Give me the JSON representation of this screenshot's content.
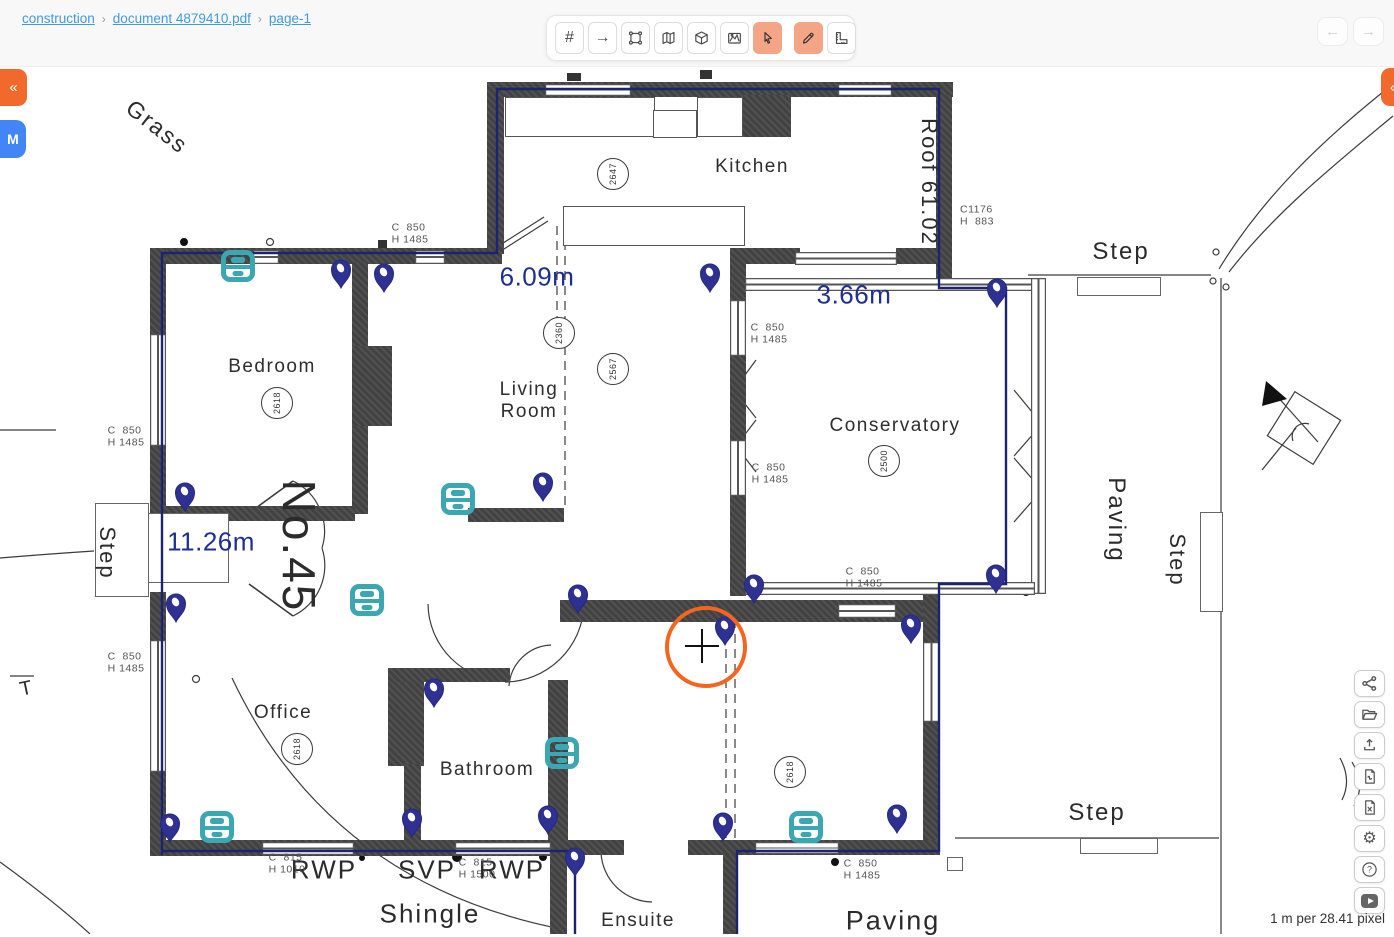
{
  "breadcrumb": {
    "separator": "›",
    "items": [
      {
        "label": "construction"
      },
      {
        "label": "document 4879410.pdf"
      },
      {
        "label": "page-1"
      }
    ]
  },
  "top_toolbar": {
    "tools": [
      {
        "name": "grid-tool",
        "glyph": "#",
        "active": false
      },
      {
        "name": "arrow-tool",
        "glyph": "→",
        "active": false
      },
      {
        "name": "polygon-select-tool",
        "active": false
      },
      {
        "name": "map-tool",
        "active": false
      },
      {
        "name": "cube-tool",
        "active": false
      },
      {
        "name": "area-chart-tool",
        "active": false
      },
      {
        "name": "pointer-tool",
        "active": true
      },
      {
        "name": "pencil-tool",
        "active": true
      },
      {
        "name": "ruler-tool",
        "active": false
      }
    ]
  },
  "nav_arrows": {
    "back": "←",
    "forward": "→"
  },
  "edge_buttons": {
    "left_collapse": "«",
    "left_m": "M",
    "right_collapse": "«"
  },
  "right_toolbar": {
    "buttons": [
      {
        "name": "share"
      },
      {
        "name": "open-folder"
      },
      {
        "name": "upload"
      },
      {
        "name": "export-pdf"
      },
      {
        "name": "export-excel"
      },
      {
        "name": "settings"
      },
      {
        "name": "help"
      },
      {
        "name": "youtube"
      }
    ]
  },
  "status": {
    "scale_label": "1 m per 28.41 pixel"
  },
  "colors": {
    "accent_orange": "#f2692c",
    "active_tool": "#f3a585",
    "link_blue": "#3f9ae3",
    "pin_navy": "#2e3192",
    "marker_teal": "#3ba7b3",
    "measure_navy": "#1e2f92",
    "m_button_blue": "#4285f4",
    "cursor_orange": "#f4661f"
  },
  "plan": {
    "rooms": [
      {
        "name": "Kitchen",
        "x": 752,
        "y": 167
      },
      {
        "name": "Bedroom",
        "x": 272,
        "y": 367
      },
      {
        "name": "Living\nRoom",
        "x": 529,
        "y": 401
      },
      {
        "name": "Conservatory",
        "x": 895,
        "y": 426
      },
      {
        "name": "Office",
        "x": 283,
        "y": 713
      },
      {
        "name": "Bathroom",
        "x": 487,
        "y": 770
      },
      {
        "name": "Ensuite",
        "x": 638,
        "y": 921
      }
    ],
    "area_labels": [
      {
        "text": "Grass",
        "x": 157,
        "y": 127,
        "rot": 38,
        "size": 23
      },
      {
        "text": "Step",
        "x": 1121,
        "y": 252,
        "rot": 0,
        "size": 24
      },
      {
        "text": "Step",
        "x": 107,
        "y": 553,
        "rot": 90,
        "size": 22
      },
      {
        "text": "Paving",
        "x": 1116,
        "y": 520,
        "rot": 90,
        "size": 24
      },
      {
        "text": "Step",
        "x": 1177,
        "y": 560,
        "rot": 90,
        "size": 22
      },
      {
        "text": "Step",
        "x": 1097,
        "y": 813,
        "rot": 0,
        "size": 24
      },
      {
        "text": "Paving",
        "x": 893,
        "y": 921,
        "rot": 0,
        "size": 27
      },
      {
        "text": "Shingle",
        "x": 430,
        "y": 914,
        "rot": 0,
        "size": 26
      },
      {
        "text": "RWP",
        "x": 324,
        "y": 870,
        "rot": 0,
        "size": 26
      },
      {
        "text": "SVP",
        "x": 427,
        "y": 870,
        "rot": 0,
        "size": 26
      },
      {
        "text": "RWP",
        "x": 512,
        "y": 870,
        "rot": 0,
        "size": 26
      },
      {
        "text": "No.45",
        "x": 299,
        "y": 546,
        "rot": 90,
        "size": 46,
        "weight": 500
      },
      {
        "text": "Roof 61.02",
        "x": 929,
        "y": 182,
        "rot": 90,
        "size": 22
      },
      {
        "text": "T",
        "x": 27,
        "y": 689,
        "rot": -12,
        "size": 20
      }
    ],
    "dims": [
      {
        "l1": "C  850",
        "l2": "H 1485",
        "x": 126,
        "y": 437
      },
      {
        "l1": "C  850",
        "l2": "H 1485",
        "x": 410,
        "y": 234
      },
      {
        "l1": "C  850",
        "l2": "H 1485",
        "x": 769,
        "y": 334
      },
      {
        "l1": "C  850",
        "l2": "H 1485",
        "x": 770,
        "y": 474
      },
      {
        "l1": "C  850",
        "l2": "H 1485",
        "x": 864,
        "y": 578
      },
      {
        "l1": "C1176",
        "l2": "H  883",
        "x": 977,
        "y": 216
      },
      {
        "l1": "C  850",
        "l2": "H 1485",
        "x": 126,
        "y": 663
      },
      {
        "l1": "C  815",
        "l2": "H 1010",
        "x": 287,
        "y": 864
      },
      {
        "l1": "C  815",
        "l2": "H 1500",
        "x": 477,
        "y": 869
      },
      {
        "l1": "C  850",
        "l2": "H 1485",
        "x": 862,
        "y": 870
      }
    ],
    "circled_numbers": [
      {
        "v": "2647",
        "x": 613,
        "y": 174
      },
      {
        "v": "2618",
        "x": 277,
        "y": 403
      },
      {
        "v": "2360",
        "x": 559,
        "y": 333
      },
      {
        "v": "2567",
        "x": 613,
        "y": 369
      },
      {
        "v": "2500",
        "x": 884,
        "y": 461
      },
      {
        "v": "2618",
        "x": 297,
        "y": 749
      },
      {
        "v": "2618",
        "x": 790,
        "y": 772
      }
    ],
    "measurements": [
      {
        "v": "6.09m",
        "x": 537,
        "y": 277
      },
      {
        "v": "3.66m",
        "x": 854,
        "y": 295
      },
      {
        "v": "11.26m",
        "x": 211,
        "y": 542
      }
    ],
    "pins": [
      [
        341,
        272
      ],
      [
        384,
        276
      ],
      [
        710,
        276
      ],
      [
        997,
        291
      ],
      [
        543,
        485
      ],
      [
        185,
        495
      ],
      [
        176,
        606
      ],
      [
        578,
        597
      ],
      [
        754,
        587
      ],
      [
        725,
        629
      ],
      [
        911,
        627
      ],
      [
        996,
        577
      ],
      [
        434,
        691
      ],
      [
        170,
        826
      ],
      [
        412,
        821
      ],
      [
        548,
        818
      ],
      [
        575,
        860
      ],
      [
        723,
        825
      ],
      [
        897,
        817
      ]
    ],
    "cameras": [
      [
        238,
        266
      ],
      [
        458,
        499
      ],
      [
        367,
        600
      ],
      [
        562,
        753
      ],
      [
        217,
        827
      ],
      [
        806,
        827
      ]
    ],
    "cursor": {
      "x": 706,
      "y": 647
    }
  }
}
